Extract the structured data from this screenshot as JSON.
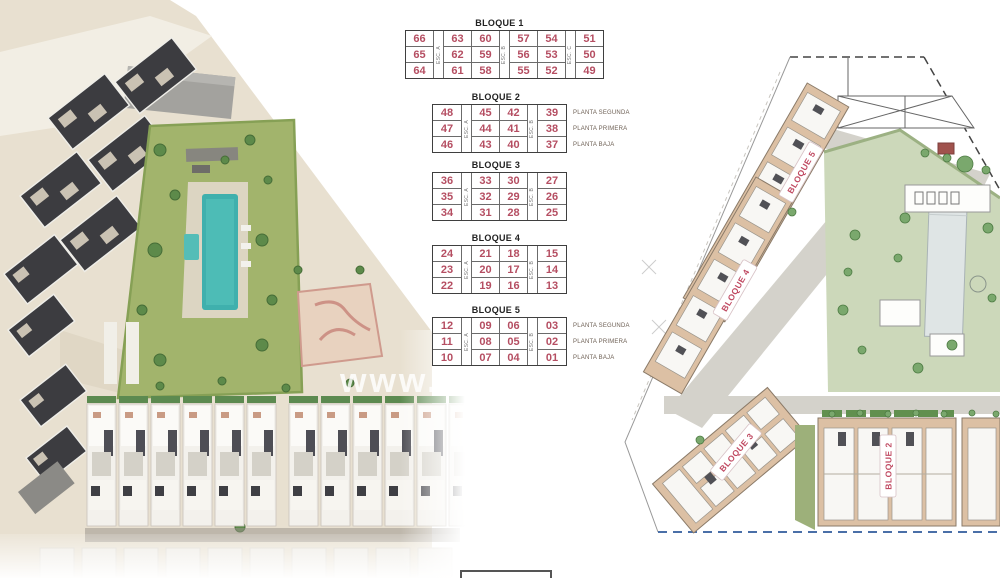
{
  "watermark": "www.",
  "colors": {
    "unit_number_red": "#b54e62",
    "plan_label_red": "#c04a62",
    "pool_teal": "#3fb0ad",
    "sand": "#e8e0d0",
    "park_green": "#a2b46c",
    "plan_green": "#ccd8ba",
    "building_tan": "#dcc0a4",
    "road_gray": "#d4d2cb",
    "boundary_blue": "#4a6fa8"
  },
  "tables": [
    {
      "title": "BLOQUE 1",
      "stairs": [
        "ESC. A",
        "ESC. B",
        "ESC. C"
      ],
      "rows": [
        [
          "66",
          "63",
          "60",
          "57",
          "54",
          "51"
        ],
        [
          "65",
          "62",
          "59",
          "56",
          "53",
          "50"
        ],
        [
          "64",
          "61",
          "58",
          "55",
          "52",
          "49"
        ]
      ],
      "floors": []
    },
    {
      "title": "BLOQUE 2",
      "stairs": [
        "ESC. A",
        "ESC. B"
      ],
      "rows": [
        [
          "48",
          "45",
          "42",
          "39"
        ],
        [
          "47",
          "44",
          "41",
          "38"
        ],
        [
          "46",
          "43",
          "40",
          "37"
        ]
      ],
      "floors": [
        "PLANTA SEGUNDA",
        "PLANTA PRIMERA",
        "PLANTA BAJA"
      ]
    },
    {
      "title": "BLOQUE 3",
      "stairs": [
        "ESC. A",
        "ESC. B"
      ],
      "rows": [
        [
          "36",
          "33",
          "30",
          "27"
        ],
        [
          "35",
          "32",
          "29",
          "26"
        ],
        [
          "34",
          "31",
          "28",
          "25"
        ]
      ],
      "floors": []
    },
    {
      "title": "BLOQUE 4",
      "stairs": [
        "ESC. A",
        "ESC. B"
      ],
      "rows": [
        [
          "24",
          "21",
          "18",
          "15"
        ],
        [
          "23",
          "20",
          "17",
          "14"
        ],
        [
          "22",
          "19",
          "16",
          "13"
        ]
      ],
      "floors": []
    },
    {
      "title": "BLOQUE 5",
      "stairs": [
        "ESC. A",
        "ESC. B"
      ],
      "rows": [
        [
          "12",
          "09",
          "06",
          "03"
        ],
        [
          "11",
          "08",
          "05",
          "02"
        ],
        [
          "10",
          "07",
          "04",
          "01"
        ]
      ],
      "floors": [
        "PLANTA SEGUNDA",
        "PLANTA PRIMERA",
        "PLANTA BAJA"
      ]
    }
  ],
  "site_plan": {
    "labels": [
      "BLOQUE 5",
      "BLOQUE 4",
      "BLOQUE 3",
      "BLOQUE 2"
    ]
  }
}
